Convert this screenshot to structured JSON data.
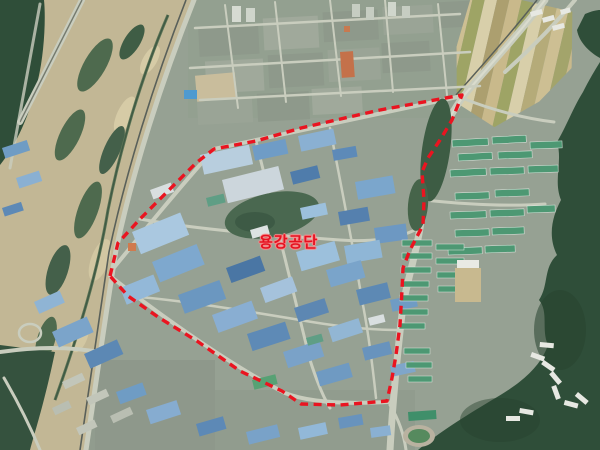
{
  "map": {
    "view": "satellite-aerial-imagery",
    "annotation": {
      "label": "용강공단",
      "label_color": "#e51220",
      "boundary": {
        "color": "#ea1420",
        "style": "dashed",
        "points": "110,276 118,243 140,219 168,191 196,163 214,149 256,141 301,128 380,110 462,95 452,120 440,140 428,158 422,172 424,200 423,225 410,250 403,268 402,290 400,325 396,355 392,378 387,401 340,405 301,404 282,391 240,371 197,341 158,317 128,296"
      }
    },
    "palette": {
      "boundary_red": "#ea1420",
      "river_sand": "#c2b795",
      "river_water": "#35523e",
      "forest_green": "#2f4e39",
      "factory_roof_blue": "#6f9cc6",
      "apartment_roof_green": "#4d9873",
      "road_gray": "#c9cdbe",
      "urban_base": "#96a193"
    }
  }
}
